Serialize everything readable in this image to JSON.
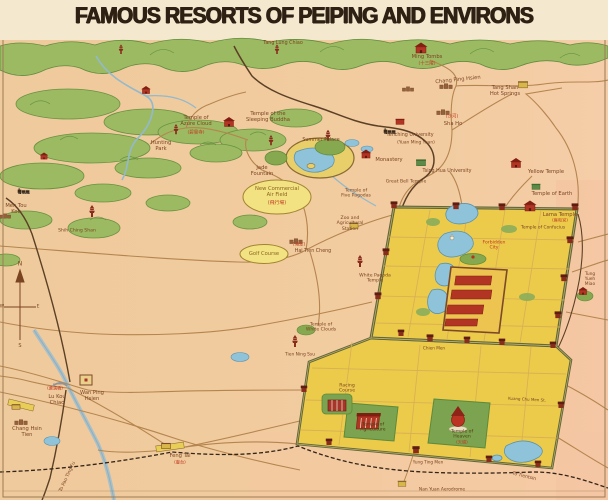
{
  "title": "FAMOUS RESORTS OF PEIPING AND ENVIRONS",
  "colors": {
    "parchment": "#f3e8cd",
    "ground": "#f0ca9c",
    "ground_east": "#f5cda6",
    "mountain": "#9cba62",
    "mountain_dark": "#628c3e",
    "water": "#8fc3da",
    "road": "#b5854f",
    "railway": "#5c4026",
    "city_fill": "#eccb4b",
    "wall": "#63653a",
    "temple_red": "#b23524",
    "label_brown": "#7a4423",
    "label_red": "#c03922",
    "oval_fill": "#f2e282"
  },
  "map": {
    "labels": [
      {
        "t": "Tang Lung Chiao",
        "x": 283,
        "y": 44,
        "s": 4.8
      },
      {
        "t": "Ming Tombs",
        "x": 427,
        "y": 57
      },
      {
        "t": "(十三陵)",
        "x": 427,
        "y": 64,
        "c": "#c03922",
        "s": 4.5
      },
      {
        "t": "Chang Ping Hsien",
        "x": 458,
        "y": 80,
        "r": -6
      },
      {
        "t": "Tang Shan\nHot Springs",
        "x": 505,
        "y": 91
      },
      {
        "t": "(沙河)",
        "x": 452,
        "y": 117,
        "c": "#c03922",
        "s": 4.5
      },
      {
        "t": "Sha Ho",
        "x": 453,
        "y": 124
      },
      {
        "t": "Temple of\nAzure Cloud",
        "x": 196,
        "y": 121
      },
      {
        "t": "(碧雲寺)",
        "x": 196,
        "y": 133,
        "c": "#c03922",
        "s": 4.5
      },
      {
        "t": "Temple of the\nSleeping Buddha",
        "x": 268,
        "y": 117
      },
      {
        "t": "Hunting\nPark",
        "x": 161,
        "y": 146
      },
      {
        "t": "Summer Palace",
        "x": 321,
        "y": 141,
        "s": 4.8
      },
      {
        "t": "Jade\nFountain",
        "x": 262,
        "y": 171
      },
      {
        "t": "Yenching University",
        "x": 410,
        "y": 136,
        "s": 4.8
      },
      {
        "t": "(Yuan Ming Yuan)",
        "x": 416,
        "y": 143,
        "s": 4.4
      },
      {
        "t": "Tsing Hua University",
        "x": 447,
        "y": 172,
        "s": 4.8
      },
      {
        "t": "Yellow Temple",
        "x": 546,
        "y": 172
      },
      {
        "t": "Temple of Earth",
        "x": 552,
        "y": 194
      },
      {
        "t": "Lama Temple",
        "x": 560,
        "y": 215
      },
      {
        "t": "(雍和宮)",
        "x": 560,
        "y": 221,
        "c": "#c03922",
        "s": 4.2
      },
      {
        "t": "Temple of Confucius",
        "x": 543,
        "y": 228,
        "s": 4.4
      },
      {
        "t": "Monastery",
        "x": 389,
        "y": 160
      },
      {
        "t": "Great Bell Temple",
        "x": 406,
        "y": 182,
        "s": 4.6
      },
      {
        "t": "Temple of\nFive Pagodas",
        "x": 356,
        "y": 194,
        "s": 4.6
      },
      {
        "t": "Zoo and\nAgricultural\nStation",
        "x": 350,
        "y": 224,
        "s": 4.6
      },
      {
        "t": "New Commercial\nAir Field",
        "x": 277,
        "y": 192,
        "c": "#8a6420"
      },
      {
        "t": "(飛行場)",
        "x": 277,
        "y": 204,
        "c": "#c03922",
        "s": 4.8
      },
      {
        "t": "Golf Course",
        "x": 264,
        "y": 254,
        "c": "#8a6420"
      },
      {
        "t": "(海淀)",
        "x": 299,
        "y": 245,
        "c": "#c03922",
        "s": 4.5
      },
      {
        "t": "Hai Tien Cheng",
        "x": 313,
        "y": 252,
        "s": 4.8
      },
      {
        "t": "White Pagoda\nTemple",
        "x": 375,
        "y": 279,
        "s": 4.6
      },
      {
        "t": "Temple of\nWhite Clouds",
        "x": 321,
        "y": 328,
        "s": 4.6
      },
      {
        "t": "Tien Ning Ssu",
        "x": 300,
        "y": 355,
        "s": 4.4
      },
      {
        "t": "Men Tou\nKou",
        "x": 16,
        "y": 209
      },
      {
        "t": "Shih Ching Shan",
        "x": 77,
        "y": 231,
        "s": 4.6
      },
      {
        "t": "(蘆溝橋)",
        "x": 55,
        "y": 389,
        "c": "#c03922",
        "s": 4.2
      },
      {
        "t": "Lu Kou\nChiao",
        "x": 57,
        "y": 400
      },
      {
        "t": "Wan Ping\nHsien",
        "x": 92,
        "y": 396
      },
      {
        "t": "Chang Hsin\nTien",
        "x": 27,
        "y": 432
      },
      {
        "t": "To Pao Ting Fu",
        "x": 68,
        "y": 477,
        "r": -65,
        "s": 4.6
      },
      {
        "t": "Feng Tai",
        "x": 180,
        "y": 456
      },
      {
        "t": "(豐台)",
        "x": 180,
        "y": 463,
        "c": "#c03922",
        "s": 4.2
      },
      {
        "t": "Racing\nCourse",
        "x": 347,
        "y": 389,
        "s": 4.6
      },
      {
        "t": "Temple of\nAgriculture",
        "x": 373,
        "y": 428,
        "s": 4.6,
        "c": "#513b15"
      },
      {
        "t": "Temple of\nHeaven",
        "x": 462,
        "y": 435,
        "s": 4.6,
        "c": "#513b15"
      },
      {
        "t": "(天壇)",
        "x": 462,
        "y": 443,
        "c": "#c03922",
        "s": 4.2
      },
      {
        "t": "Yung Ting Men",
        "x": 428,
        "y": 463,
        "s": 4.2
      },
      {
        "t": "Chien Men",
        "x": 434,
        "y": 349,
        "s": 4.2
      },
      {
        "t": "Nan Yuan Aerodrome",
        "x": 442,
        "y": 490,
        "s": 4.4
      },
      {
        "t": "To Tientsin",
        "x": 524,
        "y": 477,
        "r": 14,
        "s": 4.6
      },
      {
        "t": "Tung Yueh\nMiao",
        "x": 590,
        "y": 280,
        "s": 4.4
      },
      {
        "t": "Forbidden\nCity",
        "x": 494,
        "y": 246,
        "c": "#c03922",
        "s": 4.6
      },
      {
        "t": "Kuang Chu Men St.",
        "x": 527,
        "y": 400,
        "s": 4,
        "r": 3
      },
      {
        "t": "N",
        "x": 20,
        "y": 264,
        "s": 6
      },
      {
        "t": "S",
        "x": 20,
        "y": 347,
        "s": 5
      },
      {
        "t": "W",
        "x": 2,
        "y": 307,
        "s": 4.5
      },
      {
        "t": "E",
        "x": 38,
        "y": 307,
        "s": 4.5
      }
    ],
    "icons": [
      {
        "k": "pagoda",
        "x": 277,
        "y": 50,
        "sc": 0.8
      },
      {
        "k": "temple",
        "x": 421,
        "y": 48,
        "sc": 1.1
      },
      {
        "k": "town",
        "x": 446,
        "y": 85,
        "sc": 0.9
      },
      {
        "k": "town",
        "x": 408,
        "y": 88,
        "sc": 0.8
      },
      {
        "k": "town",
        "x": 443,
        "y": 111,
        "sc": 0.9
      },
      {
        "k": "bldg-yellow",
        "x": 523,
        "y": 85,
        "sc": 1
      },
      {
        "k": "temple",
        "x": 146,
        "y": 90,
        "sc": 0.8
      },
      {
        "k": "pagoda",
        "x": 121,
        "y": 50,
        "sc": 0.8
      },
      {
        "k": "pagoda",
        "x": 176,
        "y": 130,
        "sc": 0.85
      },
      {
        "k": "temple",
        "x": 229,
        "y": 122,
        "sc": 1
      },
      {
        "k": "temple",
        "x": 44,
        "y": 156,
        "sc": 0.7
      },
      {
        "k": "pagoda",
        "x": 92,
        "y": 212,
        "sc": 1
      },
      {
        "k": "train",
        "x": 24,
        "y": 191,
        "sc": 0.9
      },
      {
        "k": "town",
        "x": 5,
        "y": 215,
        "sc": 0.8
      },
      {
        "k": "pagoda",
        "x": 271,
        "y": 141,
        "sc": 0.85
      },
      {
        "k": "pagoda",
        "x": 328,
        "y": 136,
        "sc": 0.9
      },
      {
        "k": "train",
        "x": 390,
        "y": 131,
        "sc": 0.9
      },
      {
        "k": "bldg-red",
        "x": 400,
        "y": 122,
        "sc": 0.8
      },
      {
        "k": "temple",
        "x": 366,
        "y": 154,
        "sc": 0.9
      },
      {
        "k": "bldg-green",
        "x": 421,
        "y": 163,
        "sc": 0.9
      },
      {
        "k": "bldg-green",
        "x": 536,
        "y": 187,
        "sc": 0.8
      },
      {
        "k": "temple",
        "x": 516,
        "y": 163,
        "sc": 1
      },
      {
        "k": "temple",
        "x": 530,
        "y": 206,
        "sc": 1.1
      },
      {
        "k": "bldg-yellow",
        "x": 354,
        "y": 226,
        "sc": 0.9
      },
      {
        "k": "pagoda",
        "x": 360,
        "y": 262,
        "sc": 1
      },
      {
        "k": "pagoda",
        "x": 295,
        "y": 342,
        "sc": 1
      },
      {
        "k": "temple",
        "x": 583,
        "y": 291,
        "sc": 0.8
      },
      {
        "k": "dagoba",
        "x": 452,
        "y": 237,
        "sc": 0.9
      },
      {
        "k": "walled",
        "x": 86,
        "y": 380,
        "sc": 1
      },
      {
        "k": "bridge",
        "x": 60,
        "y": 384,
        "sc": 1
      },
      {
        "k": "town",
        "x": 21,
        "y": 421,
        "sc": 0.9
      },
      {
        "k": "station",
        "x": 166,
        "y": 446,
        "sc": 1
      },
      {
        "k": "station",
        "x": 16,
        "y": 407,
        "sc": 0.9
      },
      {
        "k": "bldg-yellow",
        "x": 402,
        "y": 484,
        "sc": 0.85
      },
      {
        "k": "town",
        "x": 296,
        "y": 240,
        "sc": 0.9
      },
      {
        "k": "gate",
        "x": 456,
        "y": 206,
        "sc": 0.9
      },
      {
        "k": "gate",
        "x": 502,
        "y": 207,
        "sc": 0.9
      },
      {
        "k": "gate",
        "x": 394,
        "y": 205,
        "sc": 0.9
      },
      {
        "k": "gate",
        "x": 575,
        "y": 207,
        "sc": 0.9
      },
      {
        "k": "gate",
        "x": 386,
        "y": 252,
        "sc": 0.9
      },
      {
        "k": "gate",
        "x": 378,
        "y": 296,
        "sc": 0.9
      },
      {
        "k": "gate",
        "x": 570,
        "y": 240,
        "sc": 0.9
      },
      {
        "k": "gate",
        "x": 564,
        "y": 278,
        "sc": 0.9
      },
      {
        "k": "gate",
        "x": 558,
        "y": 315,
        "sc": 0.9
      },
      {
        "k": "gate",
        "x": 401,
        "y": 333,
        "sc": 0.85
      },
      {
        "k": "gate",
        "x": 430,
        "y": 338,
        "sc": 0.9
      },
      {
        "k": "gate",
        "x": 467,
        "y": 340,
        "sc": 0.85
      },
      {
        "k": "gate",
        "x": 502,
        "y": 342,
        "sc": 0.85
      },
      {
        "k": "gate",
        "x": 304,
        "y": 389,
        "sc": 0.85
      },
      {
        "k": "gate",
        "x": 329,
        "y": 442,
        "sc": 0.85
      },
      {
        "k": "gate",
        "x": 416,
        "y": 450,
        "sc": 0.95
      },
      {
        "k": "gate",
        "x": 489,
        "y": 459,
        "sc": 0.85
      },
      {
        "k": "gate",
        "x": 538,
        "y": 464,
        "sc": 0.85
      },
      {
        "k": "gate",
        "x": 561,
        "y": 405,
        "sc": 0.85
      },
      {
        "k": "gate",
        "x": 553,
        "y": 345,
        "sc": 0.85
      }
    ]
  }
}
